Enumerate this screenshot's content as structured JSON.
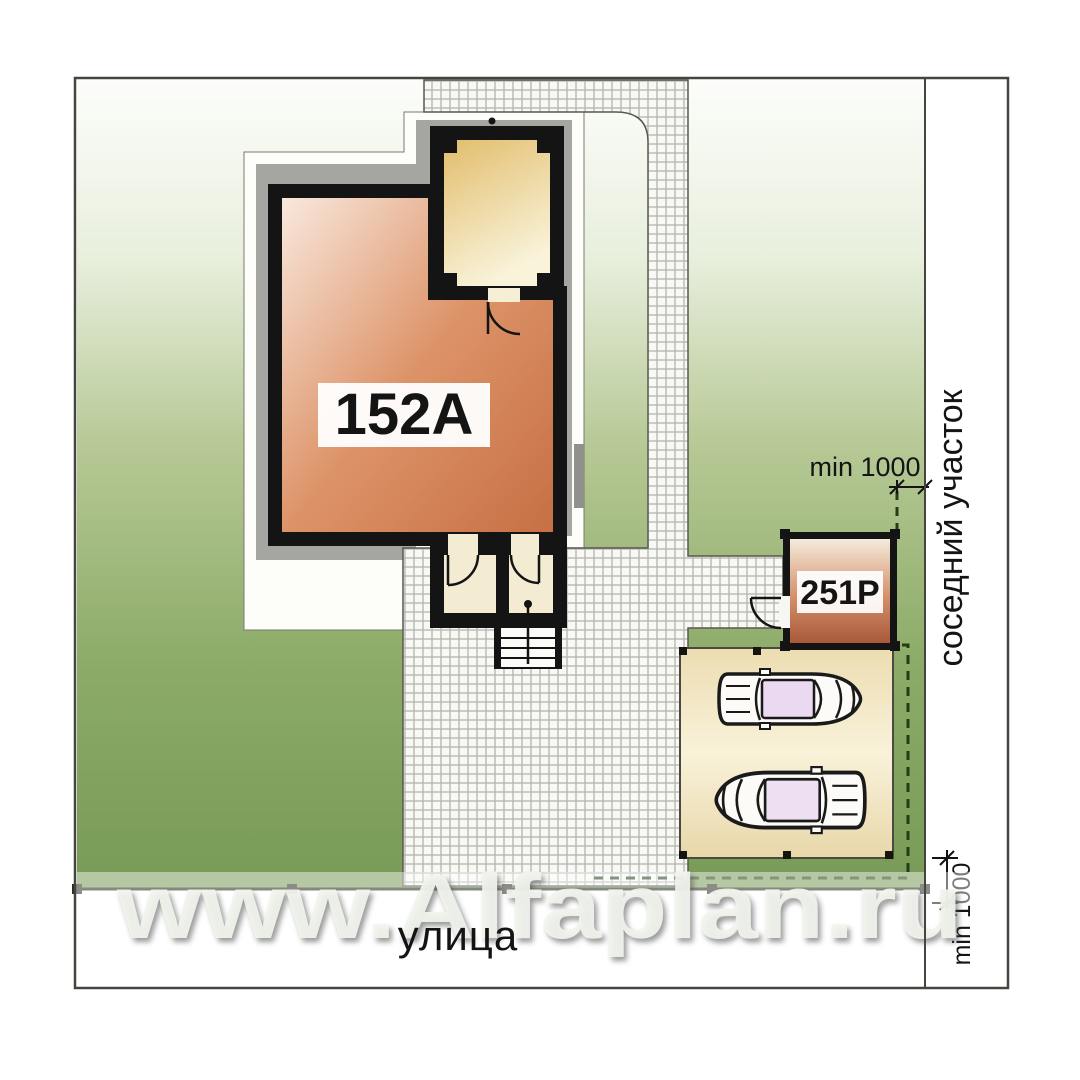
{
  "plan": {
    "house_label": "152A",
    "garage_label": "251P",
    "street_label": "улица",
    "neighbor_label": "соседний участок",
    "setback_right_label": "min 1000",
    "setback_bottom_label": "min 1000"
  },
  "watermark": {
    "text": "www.Alfaplan.ru"
  },
  "colors": {
    "ink": "#141414",
    "plot_border": "#45453f",
    "lawn_top": "#fcfdfa",
    "lawn_bottom": "#789b58",
    "room_fill": "#d98a60",
    "porch_fill": "#ecd29a",
    "garage_fill": "#c27a52",
    "cobble_tile": "#f8f8f4",
    "cobble_joint": "#b9b9b2",
    "pad_fill": "#f0e3bc",
    "apron_gray": "#a5a5a1",
    "band_white": "#fdfdfa",
    "boundary_dash": "#243d14",
    "fence": "#1f2d15",
    "glass": "#ead9f0",
    "watermark_fill": "#f2f5ee",
    "label_bg": "#ffffff"
  }
}
